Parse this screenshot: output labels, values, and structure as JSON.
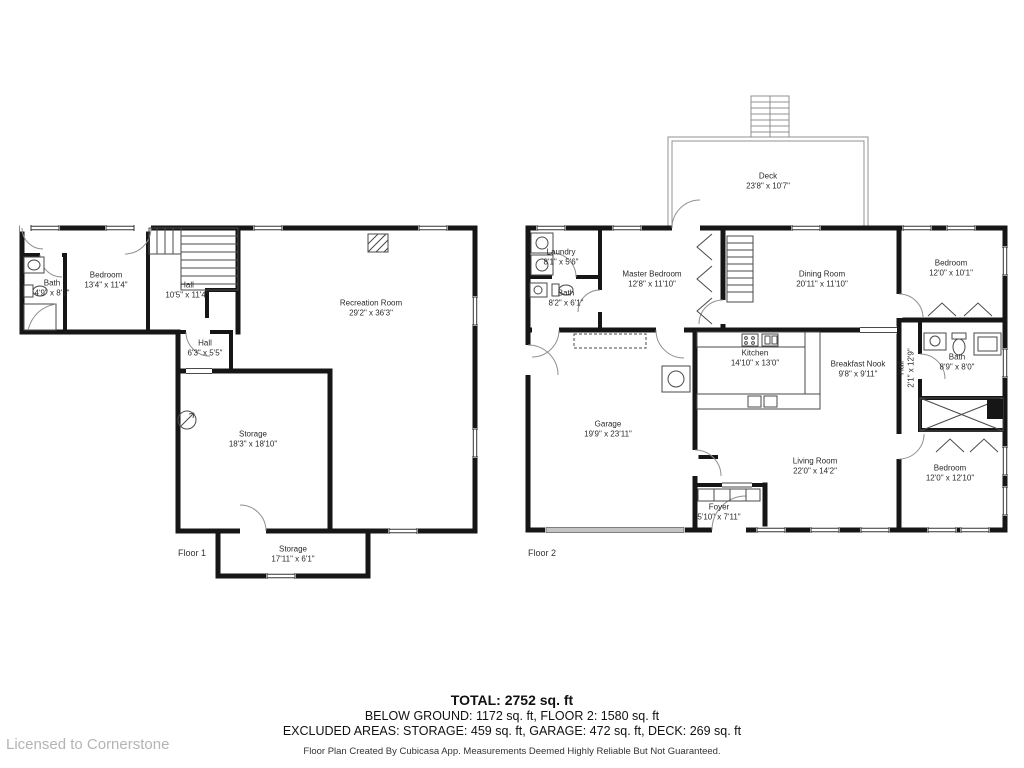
{
  "license": "Licensed to Cornerstone",
  "summary": {
    "total": "TOTAL: 2752 sq. ft",
    "floors": "BELOW GROUND: 1172 sq. ft, FLOOR 2: 1580 sq. ft",
    "excluded": "EXCLUDED AREAS: STORAGE: 459 sq. ft, GARAGE: 472 sq. ft, DECK: 269 sq. ft",
    "disclaimer": "Floor Plan Created By Cubicasa App. Measurements Deemed Highly Reliable But Not Guaranteed."
  },
  "floor1": {
    "label": "Floor 1",
    "rooms": [
      {
        "name": "Bath",
        "dims": "4'9\" x 8'1\""
      },
      {
        "name": "Bedroom",
        "dims": "13'4\" x 11'4\""
      },
      {
        "name": "Hall",
        "dims": "10'5\" x 11'4\""
      },
      {
        "name": "Recreation Room",
        "dims": "29'2\" x 36'3\""
      },
      {
        "name": "Hall",
        "dims": "6'3\" x 5'5\""
      },
      {
        "name": "Storage",
        "dims": "18'3\" x 18'10\""
      },
      {
        "name": "Storage",
        "dims": "17'11\" x 6'1\""
      }
    ]
  },
  "floor2": {
    "label": "Floor 2",
    "rooms": [
      {
        "name": "Deck",
        "dims": "23'8\" x 10'7\""
      },
      {
        "name": "Laundry",
        "dims": "8'1\" x 5'6\""
      },
      {
        "name": "Master Bedroom",
        "dims": "12'8\" x 11'10\""
      },
      {
        "name": "Bath",
        "dims": "8'2\" x 6'1\""
      },
      {
        "name": "Dining Room",
        "dims": "20'11\" x 11'10\""
      },
      {
        "name": "Bedroom",
        "dims": "12'0\" x 10'1\""
      },
      {
        "name": "Kitchen",
        "dims": "14'10\" x 13'0\""
      },
      {
        "name": "Breakfast Nook",
        "dims": "9'8\" x 9'11\""
      },
      {
        "name": "Hall",
        "dims": "2'1\" x 12'9\""
      },
      {
        "name": "Bath",
        "dims": "8'9\" x 8'0\""
      },
      {
        "name": "Garage",
        "dims": "19'9\" x 23'11\""
      },
      {
        "name": "Living Room",
        "dims": "22'0\" x 14'2\""
      },
      {
        "name": "Foyer",
        "dims": "5'10\" x 7'11\""
      },
      {
        "name": "Bedroom",
        "dims": "12'0\" x 12'10\""
      }
    ]
  }
}
